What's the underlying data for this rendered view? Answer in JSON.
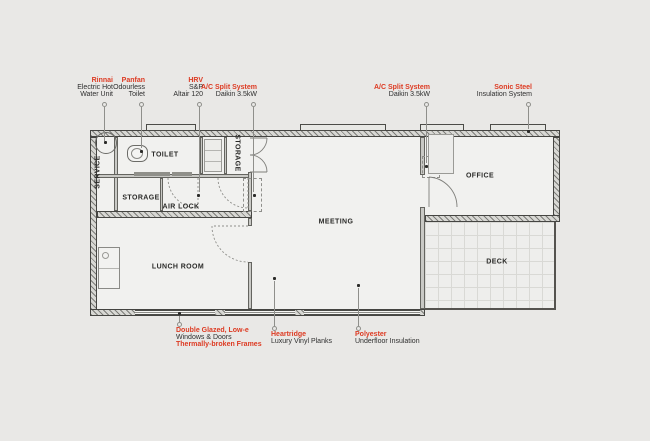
{
  "colors": {
    "background": "#e9e8e6",
    "accent_red": "#dd3a22",
    "text_dark": "#2e2e2e",
    "wall_dark": "#454542",
    "leader_gray": "#8f8f8b"
  },
  "rooms": {
    "service": "SERVICE",
    "toilet": "TOILET",
    "storage_upper": "STORAGE",
    "storage_lower": "STORAGE",
    "air_lock": "AIR LOCK",
    "lunch_room": "LUNCH ROOM",
    "meeting": "MEETING",
    "office": "OFFICE",
    "deck": "DECK"
  },
  "annotations": {
    "top": [
      {
        "title": "Rinnai",
        "details": [
          "Electric Hot",
          "Water Unit"
        ]
      },
      {
        "title": "Panfan",
        "details": [
          "Odourless",
          "Toilet"
        ]
      },
      {
        "title": "HRV",
        "details": [
          "S&P",
          "Altair 120"
        ]
      },
      {
        "title": "A/C Split System",
        "details": [
          "Daikin 3.5kW"
        ]
      },
      {
        "title": "A/C Split System",
        "details": [
          "Daikin 3.5kW"
        ]
      },
      {
        "title": "Sonic Steel",
        "details": [
          "Insulation System"
        ]
      }
    ],
    "bottom": [
      {
        "lines": [
          {
            "text": "Double Glazed, Low-e",
            "emphasis": true
          },
          {
            "text": "Windows & Doors",
            "emphasis": false
          },
          {
            "text": "Thermally-broken Frames",
            "emphasis": true
          }
        ]
      },
      {
        "lines": [
          {
            "text": "Heartridge",
            "emphasis": true
          },
          {
            "text": "Luxury Vinyl Planks",
            "emphasis": false
          }
        ]
      },
      {
        "lines": [
          {
            "text": "Polyester",
            "emphasis": true
          },
          {
            "text": "Underfloor Insulation",
            "emphasis": false
          }
        ]
      }
    ]
  }
}
